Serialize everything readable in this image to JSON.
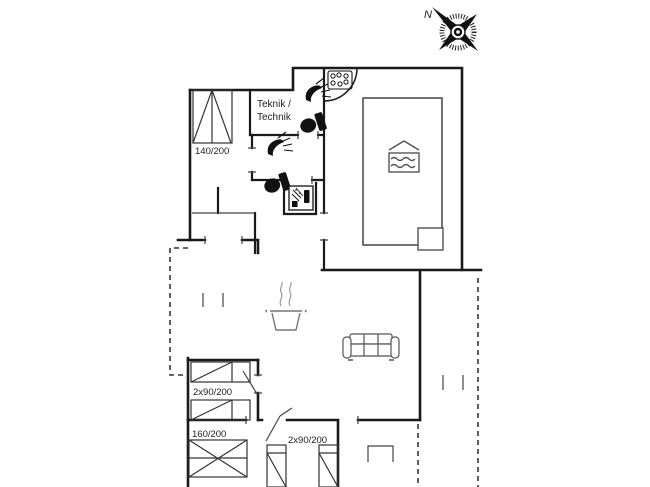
{
  "title": "Holiday house floor plan",
  "compass": {
    "north_label": "N"
  },
  "rooms": {
    "technik_line1": "Teknik /",
    "technik_line2": "Technik"
  },
  "beds": {
    "double_top_left": "140/200",
    "two_singles_left": "2x90/200",
    "double_bottom_left": "160/200",
    "two_singles_bottom": "2x90/200"
  },
  "icons": [
    "compass-rose-icon",
    "shower-icon",
    "toilet-icon",
    "whirlpool-jets-icon",
    "washbasin-icon",
    "swimming-pool-icon",
    "cooking-pot-icon",
    "sofa-icon",
    "bed-symbol"
  ],
  "colors": {
    "wall": "#1a1a1a",
    "furniture_line": "#555555",
    "icon_fill": "#111111",
    "background": "#ffffff",
    "text": "#222222"
  }
}
